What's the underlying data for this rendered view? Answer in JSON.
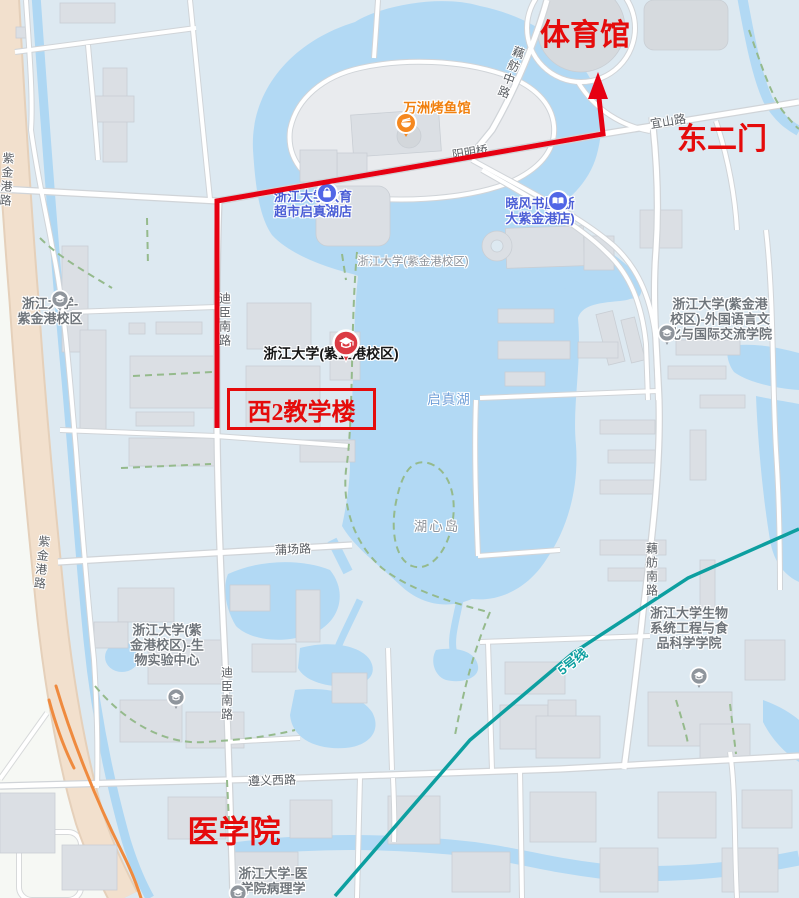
{
  "colors": {
    "annotation_red": "#e50b0b",
    "route_red": "#e60012",
    "metro_teal": "#0d9fa0",
    "water_blue": "#b2d9f4",
    "poi_blue": "#4b5ed6",
    "poi_orange": "#f0800f",
    "road_peach": "#f2e0cd",
    "ramp_orange": "#ef8a3e"
  },
  "annotations": {
    "gym": "体育馆",
    "east_gate": "东二门",
    "teaching_building": "西2教学楼",
    "medical_school": "医学院"
  },
  "pois": {
    "fish_restaurant": {
      "label": "万洲烤鱼馆",
      "icon": "bowl"
    },
    "supermarket": {
      "line1": "浙江大学教育",
      "line2": "超市启真湖店",
      "icon": "shopping-bag"
    },
    "bookstore": {
      "line1": "晓风书屋(浙",
      "line2": "大紫金港店)",
      "icon": "book"
    },
    "zju_campus_pin": {
      "label": "浙江大学(紫金港校区)",
      "icon": "graduation-cap"
    },
    "zju_campus_west": {
      "line1": "浙江大学-",
      "line2": "紫金港校区",
      "icon": "graduation-cap"
    },
    "foreign_language_college": {
      "line1": "浙江大学(紫金港",
      "line2": "校区)-外国语言文",
      "line3": "化与国际交流学院",
      "icon": "graduation-cap"
    },
    "bio_food_college": {
      "line1": "浙江大学生物",
      "line2": "系统工程与食",
      "line3": "品科学学院",
      "icon": "graduation-cap"
    },
    "bio_lab_center": {
      "line1": "浙江大学(紫",
      "line2": "金港校区)-生",
      "line3": "物实验中心",
      "icon": "graduation-cap"
    },
    "pathology_dept": {
      "line1": "浙江大学-医",
      "line2": "学院病理学",
      "icon": "graduation-cap"
    }
  },
  "area_labels": {
    "campus": "浙江大学(紫金港校区)",
    "lake": "启真湖",
    "island": "湖心岛"
  },
  "road_labels": {
    "zijingang_rd": "紫金港路",
    "zijingang_rd_top": "紫金港路",
    "dichen_south_rd": "迪臣南路",
    "dichen_south_rd_2": "迪臣南路",
    "oufang_middle_rd": "藕舫中路",
    "oufang_south_rd": "藕舫南路",
    "yishan_rd": "宜山路",
    "yangming_bridge": "阳明桥",
    "puchang_rd": "蒲场路",
    "zunyi_west_rd": "遵义西路",
    "metro_line_5": "5号线"
  }
}
